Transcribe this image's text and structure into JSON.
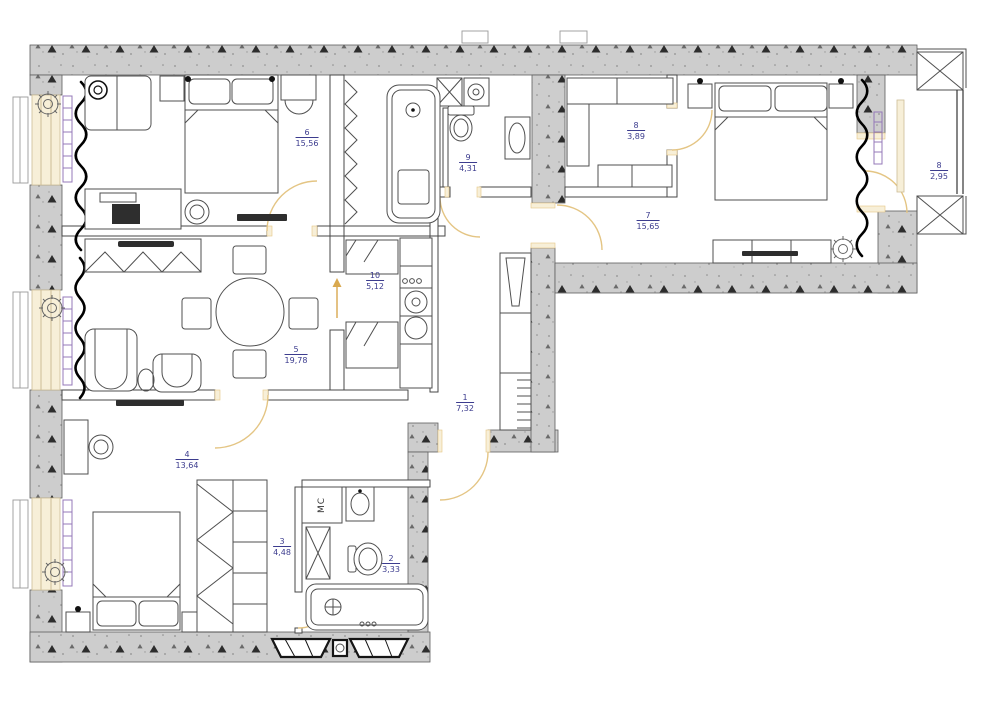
{
  "rooms": [
    {
      "id": "bedroom-top-left",
      "number": "6",
      "area": "15,56"
    },
    {
      "id": "bathroom-top",
      "number": "9",
      "area": "4,31"
    },
    {
      "id": "walkin-closet",
      "number": "8",
      "area": "3,89"
    },
    {
      "id": "bedroom-right",
      "number": "7",
      "area": "15,65"
    },
    {
      "id": "balcony",
      "number": "8",
      "area": "2,95"
    },
    {
      "id": "kitchen",
      "number": "10",
      "area": "5,12"
    },
    {
      "id": "living-room",
      "number": "5",
      "area": "19,78"
    },
    {
      "id": "entrance-hall",
      "number": "1",
      "area": "7,32"
    },
    {
      "id": "bedroom-bottom",
      "number": "4",
      "area": "13,64"
    },
    {
      "id": "corridor",
      "number": "3",
      "area": "4,48"
    },
    {
      "id": "bathroom-bottom",
      "number": "2",
      "area": "3,33"
    }
  ],
  "labels": {
    "washing_machine": "МС"
  },
  "colors": {
    "label": "#3c3c8e",
    "door_arc": "#e4c584",
    "wall_fill": "#cdcdcd",
    "window_fill": "#f7efd8",
    "radiator": "#9478b8",
    "curtain": "#000000"
  }
}
